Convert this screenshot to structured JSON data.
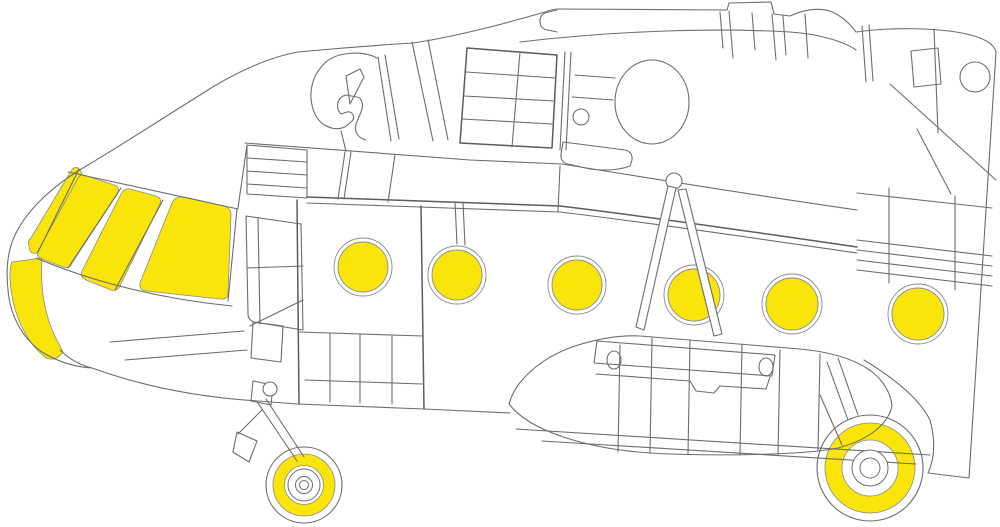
{
  "diagram": {
    "background": "#ffffff",
    "colors": {
      "mask_yellow": "#FAE50A",
      "line_gray": "#6d6d6d",
      "mask_edge": "#8c8c8c"
    },
    "canvas": {
      "width": 1000,
      "height": 527
    },
    "masks": {
      "windshield_sliver": {
        "name": "windshield-quarter-strip-mask",
        "d": "M29,246 Q27,241 31,238 L71,171 Q74,166 78,168 L82,173 L39,251 Q35,256 30,251 Z"
      },
      "windshield_panels": [
        {
          "name": "windshield-panel-left-mask",
          "d": "M84,175 L114,185 Q120,187 118,193 L72,263 Q70,269 63,267 L42,259 Q36,257 38,251 L77,180 Q80,174 84,175 Z"
        },
        {
          "name": "windshield-panel-middle-mask",
          "d": "M130,189 L156,196 Q162,198 160,204 L120,286 Q117,292 111,290 L86,280 Q80,277 82,271 L121,194 Q124,188 130,189 Z"
        },
        {
          "name": "windshield-panel-right-mask",
          "d": "M184,197 L224,206 Q231,208 231,215 L228,293 Q228,300 220,299 L146,291 Q139,290 140,283 L172,203 Q175,196 184,197 Z"
        }
      ],
      "lower_nose_window": {
        "name": "lower-nose-window-mask",
        "d": "M12,262 L42,258 Q40,286 46,311 Q51,331 60,346 L63,352 Q56,362 46,358 Q28,344 18,318 Q10,296 10,275 Q10,266 12,262 Z"
      },
      "portholes": {
        "outline_gap": 4,
        "items": [
          {
            "cx": 363,
            "cy": 267,
            "r": 25
          },
          {
            "cx": 457,
            "cy": 275,
            "r": 25
          },
          {
            "cx": 577,
            "cy": 285,
            "r": 25
          },
          {
            "cx": 694,
            "cy": 295,
            "r": 26
          },
          {
            "cx": 792,
            "cy": 304,
            "r": 26
          },
          {
            "cx": 918,
            "cy": 314,
            "r": 26
          }
        ]
      },
      "wheels": [
        {
          "name": "nose-wheel-mask",
          "cx": 304,
          "cy": 485,
          "tire_r": 38,
          "ring_outer": 31,
          "ring_inner": 19.5,
          "hub_radii": [
            16,
            8.5,
            4.5
          ]
        },
        {
          "name": "main-wheel-mask",
          "cx": 870,
          "cy": 468,
          "tire_r": 53,
          "ring_outer": 45,
          "ring_inner": 28,
          "hub_radii": [
            18,
            10
          ]
        }
      ]
    }
  }
}
